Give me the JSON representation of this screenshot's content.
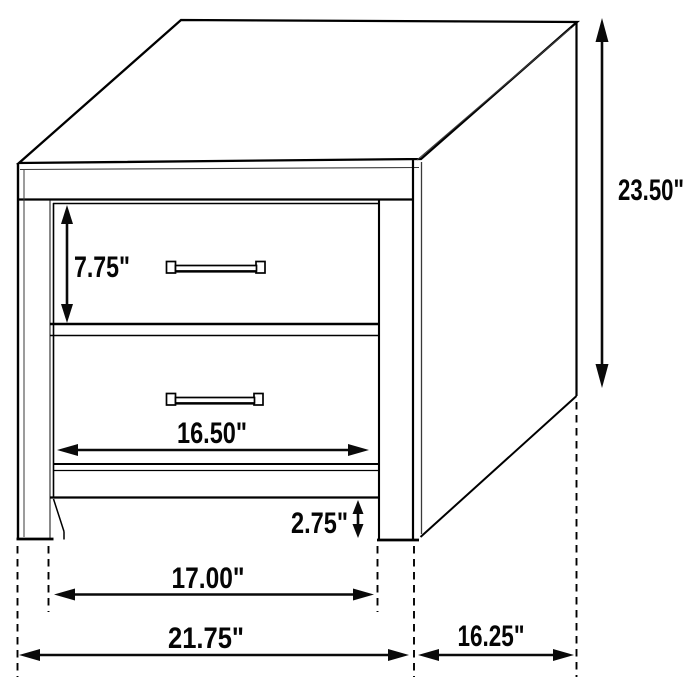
{
  "diagram": {
    "subject": "2-drawer nightstand dimension drawing",
    "units": "inches",
    "background_color": "#ffffff",
    "line_color": "#000000",
    "dims": {
      "top_drawer_height": "7.75\"",
      "overall_height": "23.50\"",
      "drawer_width": "16.50\"",
      "base_clearance": "2.75\"",
      "leg_span": "17.00\"",
      "overall_width": "21.75\"",
      "depth": "16.25\""
    }
  }
}
